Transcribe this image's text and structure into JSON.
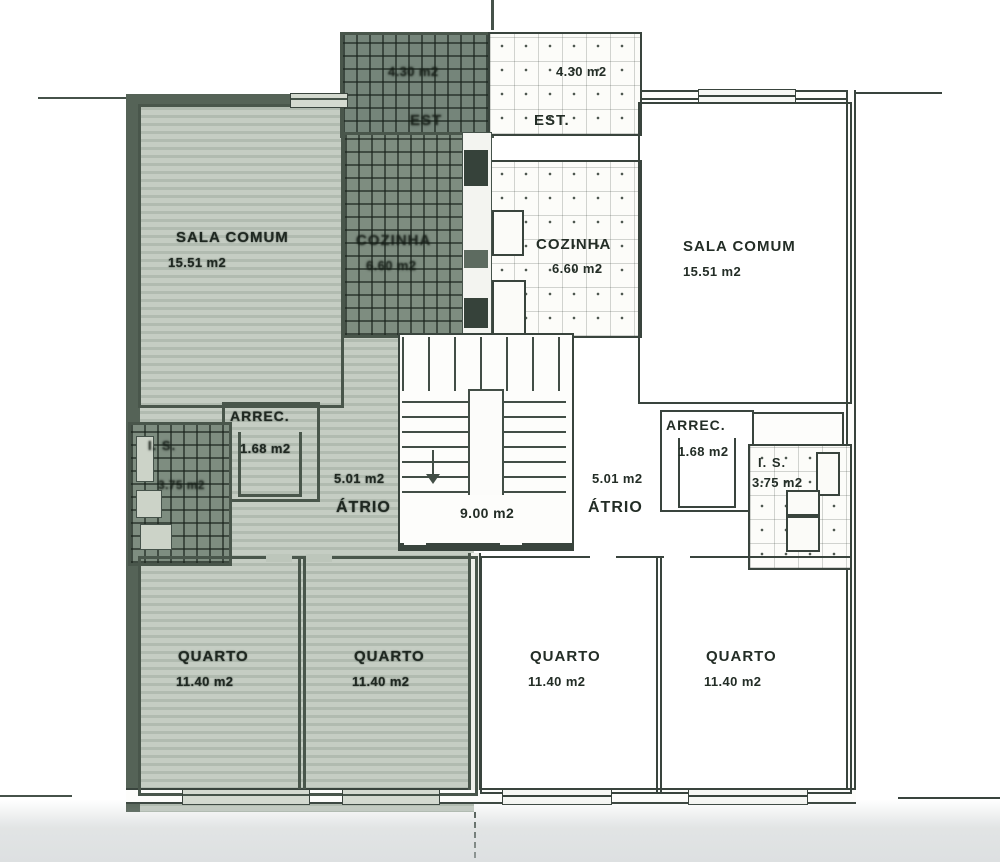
{
  "stairwell": {
    "area": "9.00 m2"
  },
  "apartments": {
    "left": {
      "sala": {
        "name": "SALA COMUM",
        "area": "15.51 m2"
      },
      "cozinha": {
        "name": "COZINHA",
        "area": "6.60 m2"
      },
      "est": {
        "name": "EST",
        "area": "4.30 m2"
      },
      "arrec": {
        "name": "ARREC.",
        "area": "1.68 m2"
      },
      "is": {
        "name": "I. S.",
        "area": "3.75 m2"
      },
      "atrio": {
        "name": "ÁTRIO",
        "area": "5.01 m2"
      },
      "quarto1": {
        "name": "QUARTO",
        "area": "11.40 m2"
      },
      "quarto2": {
        "name": "QUARTO",
        "area": "11.40 m2"
      }
    },
    "right": {
      "sala": {
        "name": "SALA COMUM",
        "area": "15.51 m2"
      },
      "cozinha": {
        "name": "COZINHA",
        "area": "6.60 m2"
      },
      "est": {
        "name": "EST.",
        "area": "4.30 m2"
      },
      "arrec": {
        "name": "ARREC.",
        "area": "1.68 m2"
      },
      "is": {
        "name": "I. S.",
        "area": "3.75 m2"
      },
      "atrio": {
        "name": "ÁTRIO",
        "area": "5.01 m2"
      },
      "quarto1": {
        "name": "QUARTO",
        "area": "11.40 m2"
      },
      "quarto2": {
        "name": "QUARTO",
        "area": "11.40 m2"
      }
    }
  }
}
